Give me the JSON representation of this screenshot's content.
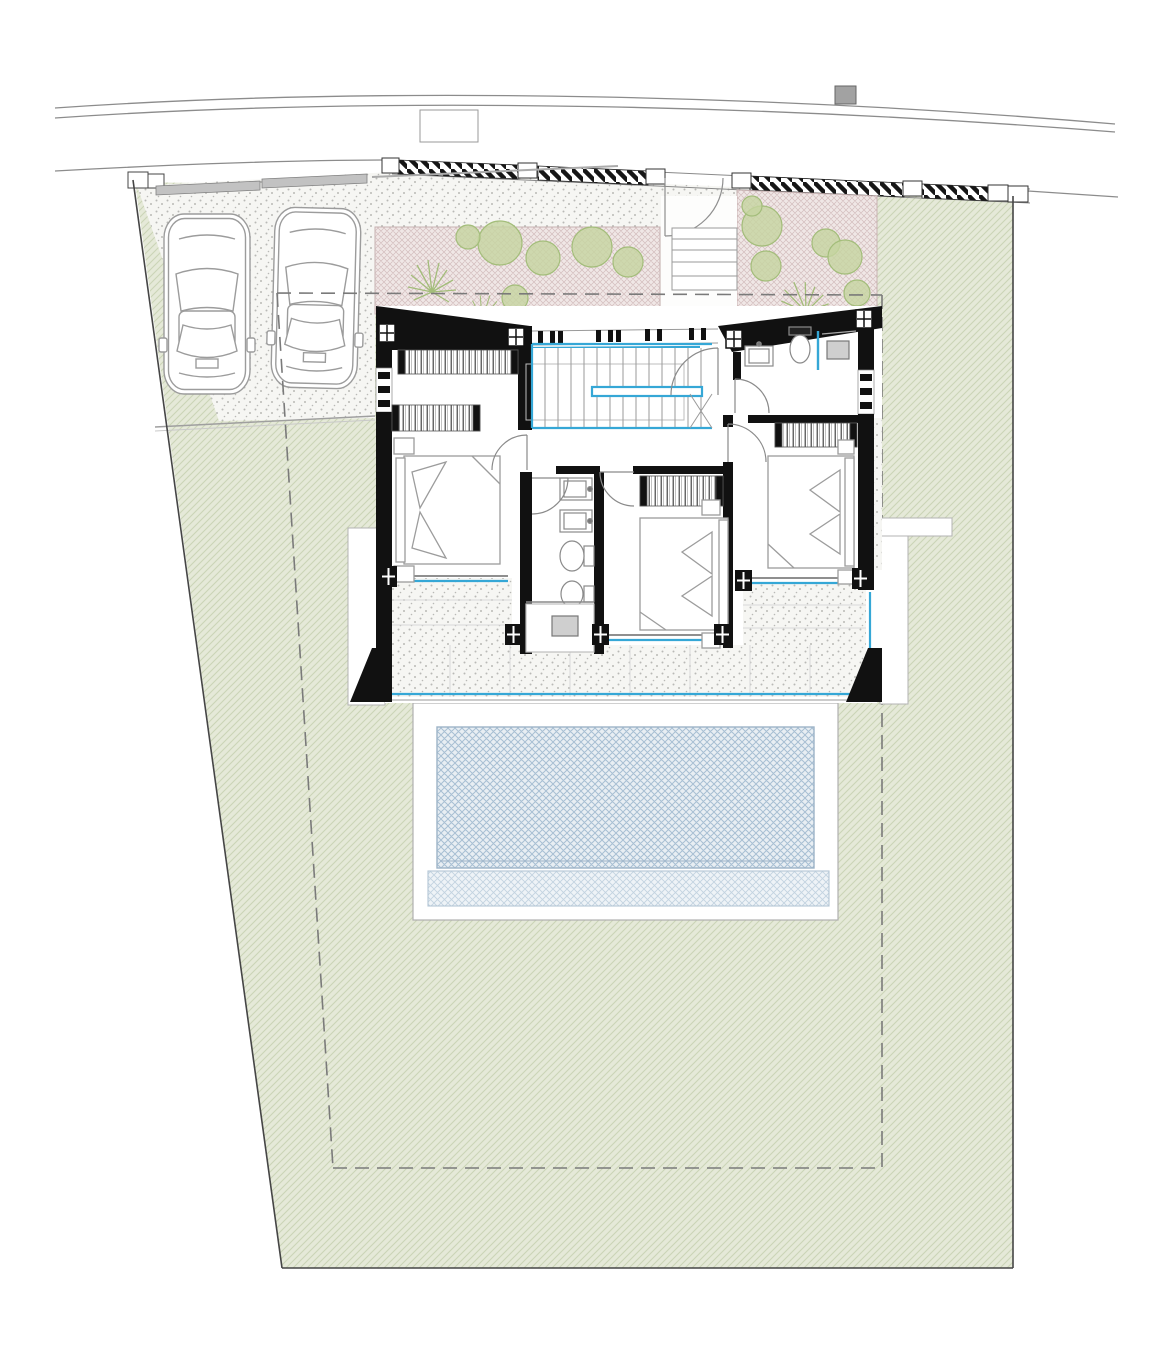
{
  "page": {
    "width": 1170,
    "height": 1365,
    "background": "#ffffff"
  },
  "drawing": {
    "kind": "architectural-site-and-floor-plan"
  },
  "colors": {
    "page_bg": "#ffffff",
    "road_stroke": "#8c8c8c",
    "boundary_stroke": "#454545",
    "setback_dash": "#7a7a7a",
    "lawn_bg": "#e5e9d8",
    "lawn_line": "#cbd4b6",
    "paving_bg": "#f6f6f3",
    "paving_dot": "#b9b9b6",
    "planter_bg": "#f0e7e6",
    "planter_line": "#d2bcbc",
    "plant_fill": "#c5d5a0",
    "plant_stroke": "#a3bd7a",
    "wall_fill": "#111111",
    "band_stripe": "#161616",
    "accent_blue": "#35a7d6",
    "pool_bg": "#e8eef3",
    "pool_line": "#a7bfd3",
    "pool_shallow_bg": "#eef3f7",
    "pool_shallow_line": "#c2d3e0",
    "fixture_stroke": "#8a8a8a",
    "furniture_stroke": "#9c9c9c",
    "wardrobe_stroke": "#333333",
    "deck_stroke": "#b0b0b0",
    "utility_fill": "#a2a2a2",
    "gate_fill": "#c2c2c2",
    "slab_stroke": "#9a9a9a",
    "joint_line": "#d8d8d8"
  },
  "symbols": [
    "road",
    "road-marking",
    "utility-box",
    "plot-boundary",
    "setback-line",
    "lawn",
    "driveway-paving",
    "sliding-gate",
    "boundary-wall-hatch",
    "boundary-post",
    "car",
    "planting-bed",
    "shrub",
    "fern",
    "entry-gate",
    "entry-steps",
    "house-slab",
    "roof-edge",
    "column-post",
    "window",
    "staircase",
    "stair-handrail",
    "wardrobe",
    "double-bed",
    "pillow",
    "nightstand",
    "door-swing",
    "sink",
    "toilet",
    "bidet",
    "shower-drain",
    "shower-glass",
    "terrace-paving",
    "glass-balustrade",
    "pool-deck",
    "swimming-pool",
    "pool-shallow-ledge"
  ]
}
